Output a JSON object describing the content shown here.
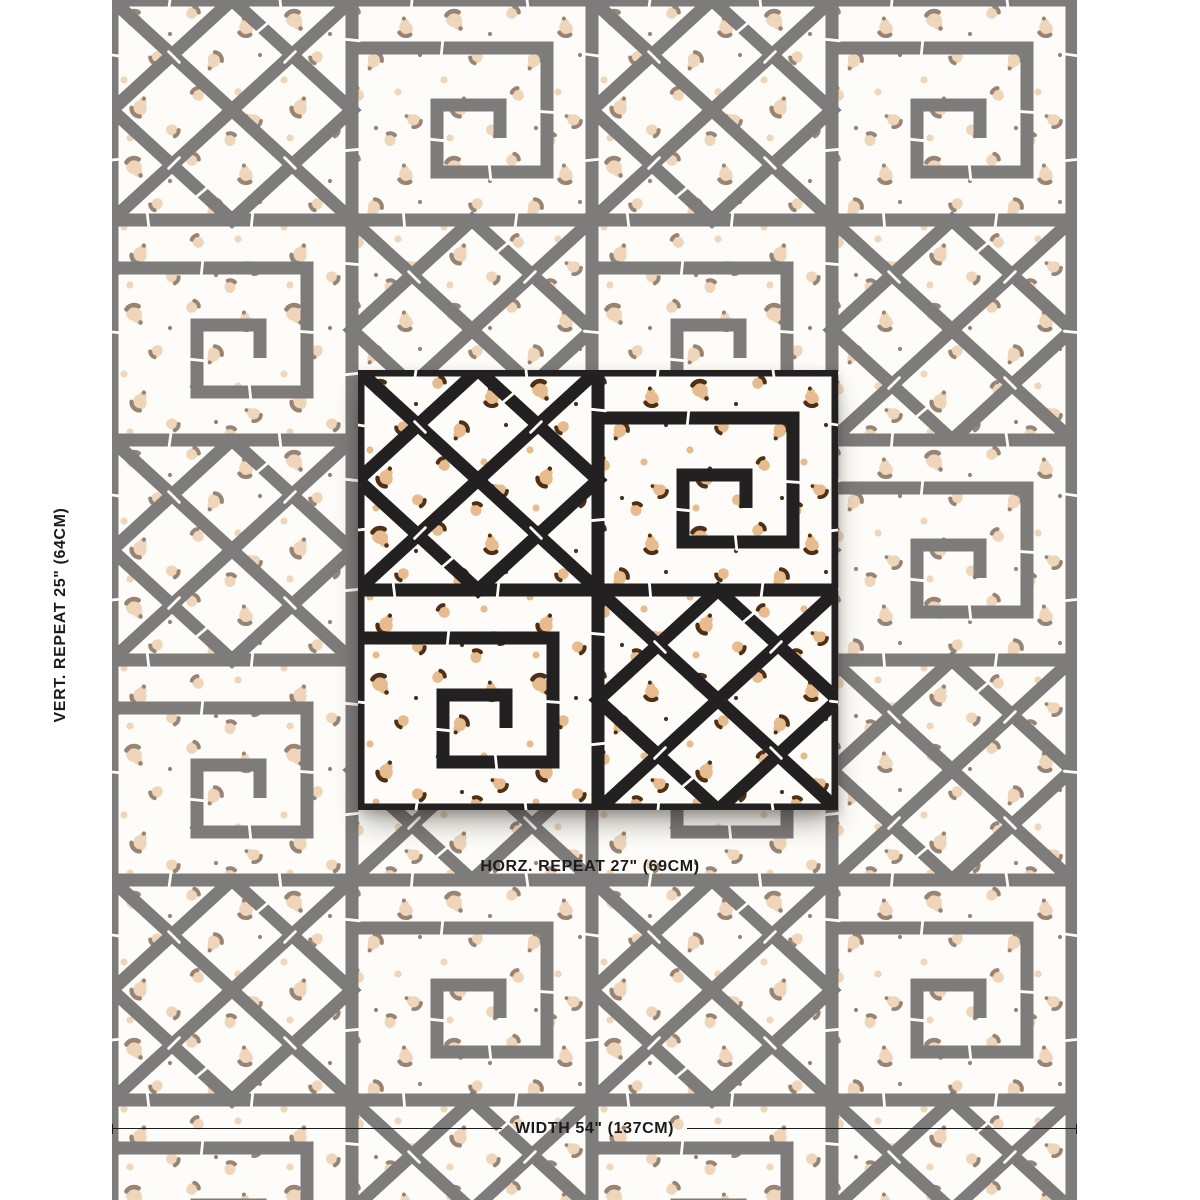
{
  "labels": {
    "vertical_repeat": "VERT. REPEAT 25\" (64CM)",
    "horizontal_repeat": "HORZ. REPEAT 27\" (69CM)",
    "width": "WIDTH 54\" (137CM)"
  },
  "colors": {
    "lattice": "#232022",
    "spot_tan": "#e6bb8e",
    "spot_brown": "#4f2f16",
    "fabric_ground": "#fdfcf8",
    "label_text": "#1b1a1c"
  }
}
